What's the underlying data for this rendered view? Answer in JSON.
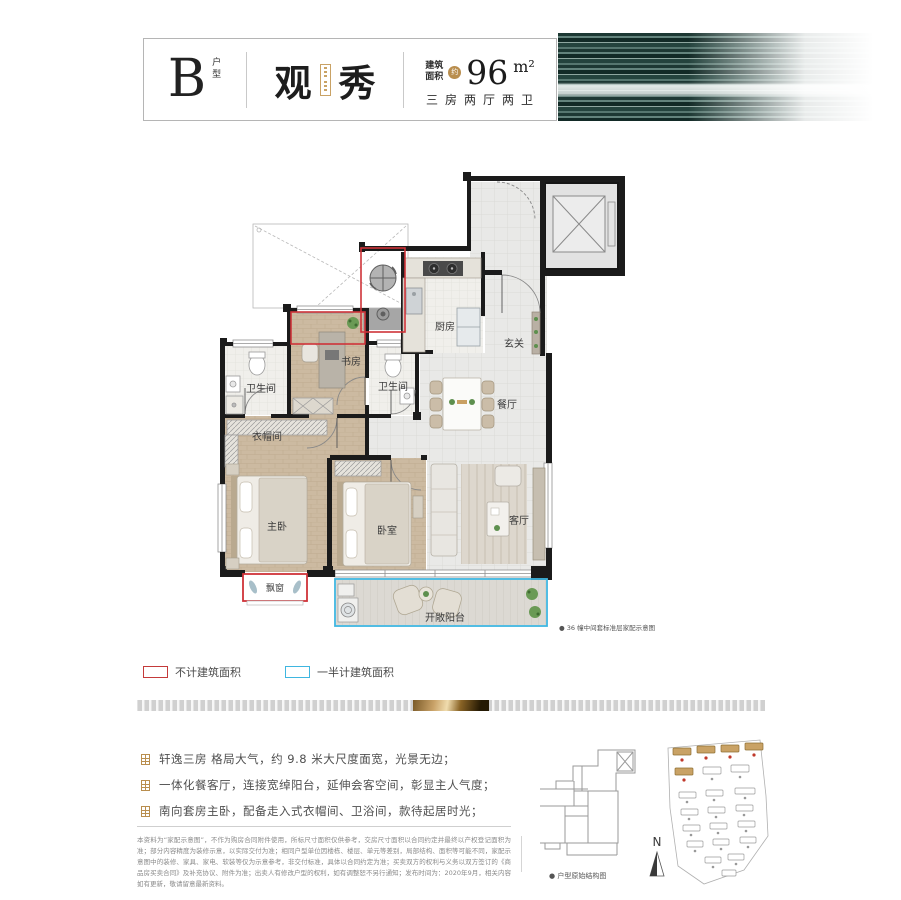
{
  "header": {
    "unit_letter": "B",
    "unit_type_label": "户型",
    "name_char1": "观",
    "name_char2": "秀",
    "area_label": "建筑\n面积",
    "area_approx": "约",
    "area_value": "96",
    "area_unit": "m²",
    "layout_desc": "三房两厅两卫"
  },
  "floorplan": {
    "rooms": {
      "kitchen": "厨房",
      "foyer": "玄关",
      "study": "书房",
      "bath_left": "卫生间",
      "bath_center": "卫生间",
      "dining": "餐厅",
      "closet": "衣帽间",
      "master": "主卧",
      "bedroom": "卧室",
      "living": "客厅",
      "baywindow": "飘窗",
      "balcony": "开敞阳台"
    },
    "note": "● 36 幢中间套标准层家配示意图"
  },
  "legend": {
    "not_counted": "不计建筑面积",
    "half_counted": "一半计建筑面积",
    "red": "#c43a3a",
    "blue": "#3fb6e0"
  },
  "features": [
    "轩逸三房 格局大气，约 9.8 米大尺度面宽，光景无边；",
    "一体化餐客厅，连接宽绰阳台，延伸会客空间，彰显主人气度；",
    "南向套房主卧，配备走入式衣帽间、卫浴间，款待起居时光；"
  ],
  "disclaimer": "本资料为“家配示意图”，不作为购房合同附件使用，所标尺寸面积仅供参考，交房尺寸面积以合同约定并最终以产权登记面积为准；部分内容精度为装修示意，以实际交付为准；相同户型单位因楼栋、楼层、单元等差别，局部结构、面积等可能不同，家配示意图中的装修、家具、家电、软装等仅为示意参考，非交付标准，具体以合同约定为准；买卖双方的权利与义务以双方签订的《商品房买卖合同》及补充协议、附件为准；出卖人有修改户型的权利，如有调整恕不另行通知；发布时间为：2020年9月，相关内容如有更新，敬请留意最新资料。",
  "footer": {
    "structure_label": "● 户型原始结构图",
    "north_label": "N"
  }
}
